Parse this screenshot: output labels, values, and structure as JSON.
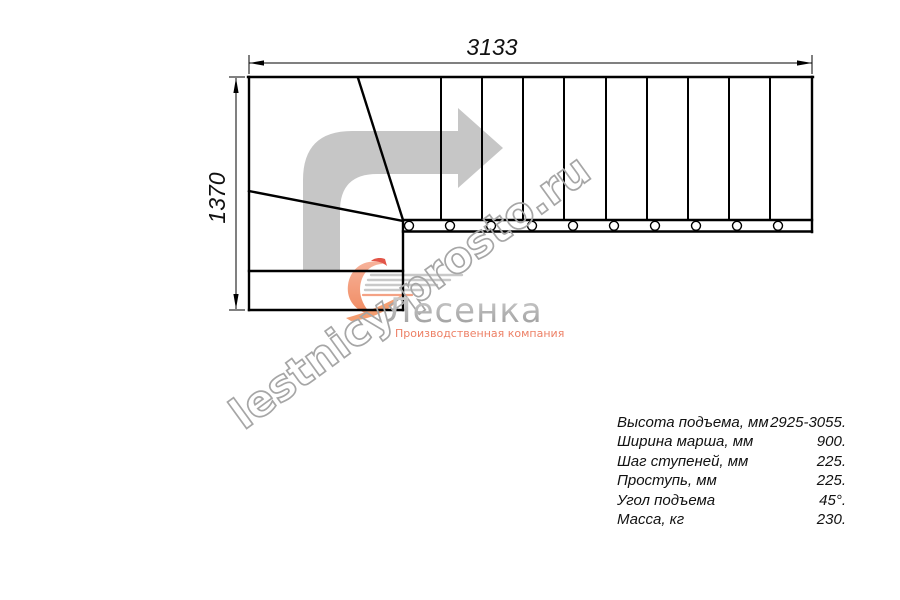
{
  "diagram": {
    "dim_width": "3133",
    "dim_height": "1370"
  },
  "watermark": {
    "text": "lestnicy-prosto.ru"
  },
  "logo": {
    "name": "Лесенка",
    "subtitle": "Производственная компания",
    "swirl_color": "#f4946f",
    "accent_red": "#e25548"
  },
  "drawing_colors": {
    "line": "#000000",
    "direction_arrow": "#c6c6c6",
    "watermark_outline": "#a6a6a6"
  },
  "specs": [
    {
      "label": "Высота подъема, мм",
      "value": "2925-3055."
    },
    {
      "label": "Ширина марша, мм",
      "value": "900."
    },
    {
      "label": "Шаг ступеней, мм",
      "value": "225."
    },
    {
      "label": "Проступь, мм",
      "value": "225."
    },
    {
      "label": "Угол подъема",
      "value": "45°."
    },
    {
      "label": "Масса, кг",
      "value": "230."
    }
  ]
}
